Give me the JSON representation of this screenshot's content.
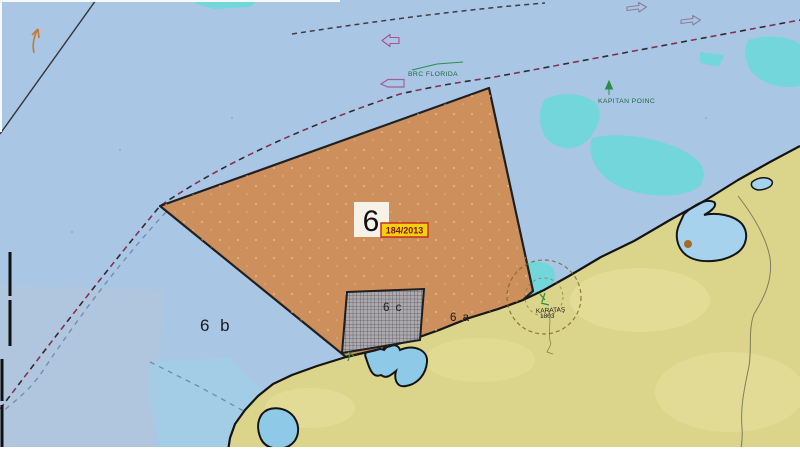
{
  "chart": {
    "zones": {
      "main_label": "6",
      "regulation_badge": "184/2013",
      "sub_a": "6 a",
      "sub_b": "6 b",
      "sub_c": "6 c"
    },
    "vessels": {
      "vessel_1": "BRC FLORIDA",
      "vessel_2": "KAPITAN POINC"
    },
    "station": {
      "label_line_1": "KARATAŞ",
      "label_line_2": "1803"
    },
    "colors": {
      "sea": "#a9c7e5",
      "shallow_water": "#72d6da",
      "land": "#dbd58b",
      "lagoon": "#a6d2ee",
      "zone_fill": "#cf8d57",
      "zone_border": "#1a1a1a",
      "badge_bg": "#f5cf0a",
      "badge_border": "#c23022",
      "badge_text": "#7a1515",
      "vessel_label_green": "#1c6b40",
      "boundary_dashed_maroon": "#8a3050",
      "boundary_dashed_blue": "#6e8cab",
      "hatch_area": "#a9adb5"
    },
    "icons": {
      "vessel_outline_icon": "magenta ship outline",
      "direction_arrow_icon": "open route arrow",
      "ais_target_icon": "green triangle with heading line",
      "range_circle_icon": "dashed range circle",
      "scale_bar": "black edge bar",
      "current_arrow_icon": "small orange arrow"
    }
  }
}
